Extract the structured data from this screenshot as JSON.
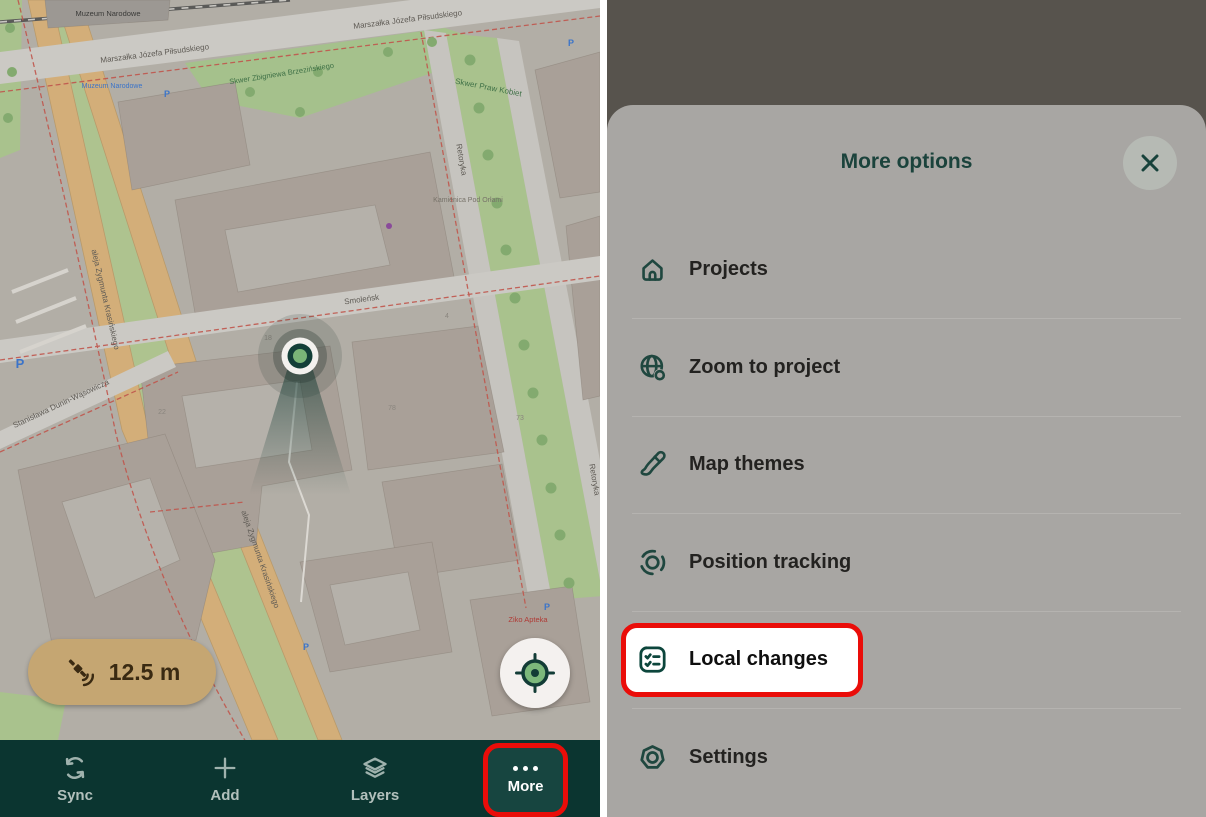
{
  "left_panel": {
    "map": {
      "gps_accuracy": "12.5 m",
      "labels": {
        "museum": "Muzeum Narodowe",
        "museum_stop": "Muzeum Narodowe",
        "pilsudskiego": "Marszałka Józefa Piłsudskiego",
        "brzezinski_park": "Skwer Zbigniewa Brzezińskiego",
        "praw_kobiet_park": "Skwer Praw Kobiet",
        "smolensk": "Smoleńsk",
        "retoryka": "Retoryka",
        "krasinskiego": "aleja Zygmunta Krasińskiego",
        "dunin": "Stanisława Dunin-Wąsowicza",
        "ziko": "Ziko Apteka",
        "kamienica": "Kamienica Pod Orłami",
        "parking": "P",
        "house_numbers": [
          "22",
          "18",
          "78",
          "4",
          "73"
        ]
      }
    },
    "nav": {
      "items": [
        {
          "label": "Sync"
        },
        {
          "label": "Add"
        },
        {
          "label": "Layers"
        },
        {
          "label": "More"
        }
      ]
    }
  },
  "modal": {
    "title": "More options",
    "items": [
      {
        "label": "Projects",
        "icon": "home-icon"
      },
      {
        "label": "Zoom to project",
        "icon": "globe-search-icon"
      },
      {
        "label": "Map themes",
        "icon": "brush-icon"
      },
      {
        "label": "Position tracking",
        "icon": "tracking-icon"
      },
      {
        "label": "Local changes",
        "icon": "checklist-icon",
        "highlighted": true
      },
      {
        "label": "Settings",
        "icon": "gear-icon"
      }
    ]
  },
  "colors": {
    "accent_teal": "#0d463c",
    "nav_bg": "#0b3530",
    "highlight_red": "#ea0d09",
    "pill_bg": "#c5a672",
    "marker_green": "#79b577",
    "sheet_bg": "#a8a6a3",
    "dim_bg": "#57534d"
  }
}
